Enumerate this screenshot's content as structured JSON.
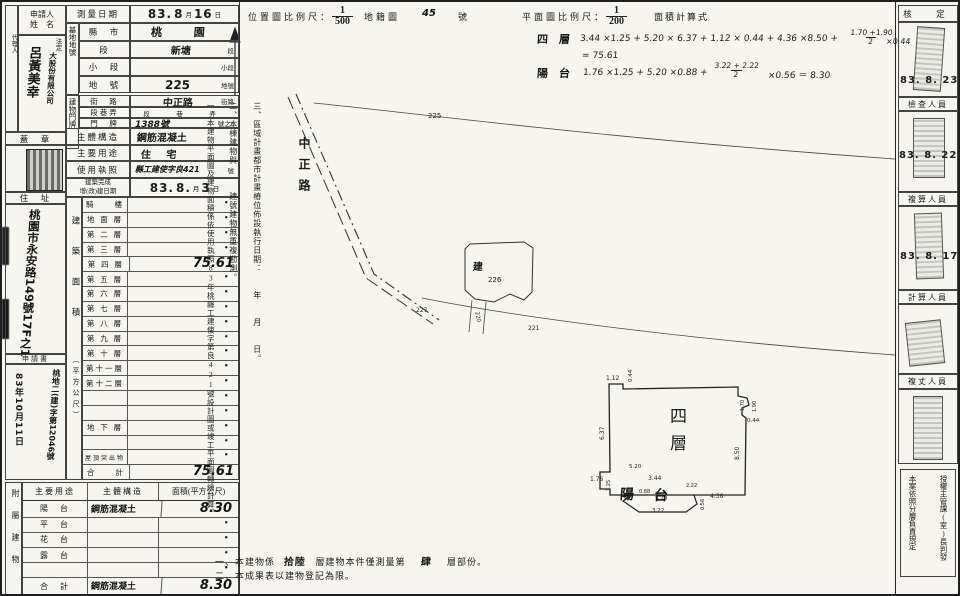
{
  "header": {
    "location_scale_label": "位置圖比例尺：",
    "location_scale_num": "1",
    "location_scale_den": "500",
    "cadastre_label": "地籍圖",
    "cadastre_no": "45",
    "cadastre_suffix": "號",
    "plan_scale_label": "平面圖比例尺：",
    "plan_scale_num": "1",
    "plan_scale_den": "200",
    "area_calc_label": "面積計算式"
  },
  "formulas": {
    "floor4_label": "四　層",
    "floor4_expr1": "3.44 ×1.25 + 5.20 × 6.37 + 1.12 × 0.44 + 4.36 ×8.50 +",
    "floor4_frac_num": "1.70 +1.90",
    "floor4_frac_den": "2",
    "floor4_expr2": "×0.44",
    "floor4_result": "= 75.61",
    "balcony_label": "陽　台",
    "balcony_expr1": "1.76 ×1.25 + 5.20 ×0.88 +",
    "balcony_frac_num": "3.22 + 2.22",
    "balcony_frac_den": "2",
    "balcony_expr2": "×0.56 ＝ 8.30"
  },
  "form": {
    "applicant_header_1": "申請人",
    "applicant_header_2": "姓　名",
    "agent_label": "代理人",
    "applicant_extra": "法定",
    "applicant_company": "大股份有限公司",
    "applicant_name": "呂黃美幸",
    "seal_label": "蓋　章",
    "address_label": "住　址",
    "address_value": "桃園市永安路149號17F之1",
    "application_label": "申請書",
    "application_no": "桃地二(建)字第12046號",
    "application_date": "83年10月11日",
    "survey_date_label": "測量日期",
    "survey_date": {
      "y": "83.",
      "m": "8",
      "m_suffix": "月",
      "d": "16",
      "d_suffix": "日"
    },
    "site_group": "基地地號",
    "county_label": "縣　市",
    "county_value": "桃 園",
    "section_label": "段",
    "section_value": "新塘",
    "section_suffix": "段",
    "subsection_label": "小　段",
    "subsection_suffix": "小段",
    "parcel_label": "地　號",
    "parcel_value": "225",
    "parcel_suffix": "地號",
    "door_group": "建物門牌",
    "street_label": "街　路",
    "street_value": "中正路",
    "street_suffix": "街路",
    "lane_label": "段巷弄",
    "lane_suffix": "段　巷　弄",
    "door_label": "門　牌",
    "door_value": "1388號",
    "door_suffix": "號之5",
    "structure_label": "主體構造",
    "structure_value": "鋼筋混凝土",
    "usage_label": "主要用途",
    "usage_value": "住 宅",
    "license_label": "使用執照",
    "license_value": "縣工建使字良421",
    "license_suffix": "號",
    "completion_label_1": "建築完成",
    "completion_label_2": "增(改)建日期",
    "completion_date": {
      "y": "83.",
      "m": "8.",
      "m_suffix": "月",
      "d": "3",
      "d_suffix": "日"
    },
    "area_col_label": "建築面積",
    "area_col_unit": "（平方公尺）",
    "floors": [
      {
        "label": "騎　　樓",
        "value": "•"
      },
      {
        "label": "地 面 層",
        "value": "•"
      },
      {
        "label": "第 二 層",
        "value": "•"
      },
      {
        "label": "第 三 層",
        "value": "•"
      },
      {
        "label": "第 四 層",
        "value": "75.61"
      },
      {
        "label": "第 五 層",
        "value": "•"
      },
      {
        "label": "第 六 層",
        "value": "•"
      },
      {
        "label": "第 七 層",
        "value": "•"
      },
      {
        "label": "第 八 層",
        "value": "•"
      },
      {
        "label": "第 九 層",
        "value": "•"
      },
      {
        "label": "第 十 層",
        "value": "•"
      },
      {
        "label": "第十一層",
        "value": "•"
      },
      {
        "label": "第十二層",
        "value": "•"
      },
      {
        "label": "",
        "value": "•"
      },
      {
        "label": "",
        "value": "•"
      },
      {
        "label": "地 下 層",
        "value": "•"
      },
      {
        "label": "",
        "value": "•"
      },
      {
        "label": "屋頂突出物",
        "value": "•"
      },
      {
        "label": "合　　計",
        "value": "75.61"
      }
    ]
  },
  "attached": {
    "group_label": "附屬建物",
    "headers": [
      "主要用途",
      "主體構造",
      "面積(平方公尺)"
    ],
    "rows": [
      {
        "use": "陽　台",
        "structure": "鋼筋混凝土",
        "area": "8.30"
      },
      {
        "use": "平　台",
        "structure": "",
        "area": "•"
      },
      {
        "use": "花　台",
        "structure": "",
        "area": "•"
      },
      {
        "use": "露　台",
        "structure": "",
        "area": "•"
      },
      {
        "use": "",
        "structure": "",
        "area": "•"
      },
      {
        "use": "合　計",
        "structure": "鋼筋混凝土",
        "area": "8.30"
      }
    ]
  },
  "notes_vertical": {
    "n1": "一、本建物平面圖及建物面積係依使用執照83年桃縣工建使字第良421號設計圖或竣工平面圖轉繪計算。",
    "n2": "二、本棟建物與　　　建號建物無重複勘測。",
    "n3": "三、區域計畫都市計畫樁位佈設執行日期：　　年　　月　　日。"
  },
  "map": {
    "road_name": "中正路",
    "p225": "225",
    "p226": "226",
    "p227": "227",
    "p221": "221",
    "p220": "220",
    "building_mark": "建"
  },
  "plan": {
    "floor_label": "四層",
    "balcony_1": "陽",
    "balcony_2": "台",
    "dims": {
      "d112": "1.12",
      "d044a": "0.44",
      "d637": "6.37",
      "d850": "8.50",
      "d170": "1.70",
      "d190": "1.90",
      "d044b": "0.44",
      "d520a": "5.20",
      "d176": "1.76",
      "d125": "1.25",
      "d344": "3.44",
      "d088": "0.88",
      "d520b": "5.20",
      "d222": "2.22",
      "d056": "0.56",
      "d436": "4.36",
      "d322": "3.22"
    }
  },
  "bottom_notes": {
    "l1_pre": "一、本建物係",
    "l1_hw1": "拾陸",
    "l1_mid": "層建物本件僅測量第",
    "l1_hw2": "肆",
    "l1_post": "層部份。",
    "l2": "二、本成果表以建物登記為限。"
  },
  "right_panel": {
    "approve_label": "核　定",
    "approve_date": "83. 8. 23",
    "check_label": "檢查人員",
    "check_date": "83. 8. 22",
    "recheck_label": "複算人員",
    "recheck_date": "83. 8. 17",
    "calc_label": "計算人員",
    "measure_label": "複丈人員",
    "footer_line1": "授權主管課(室)長判發",
    "footer_line2": "本案依照分層負責規定"
  }
}
